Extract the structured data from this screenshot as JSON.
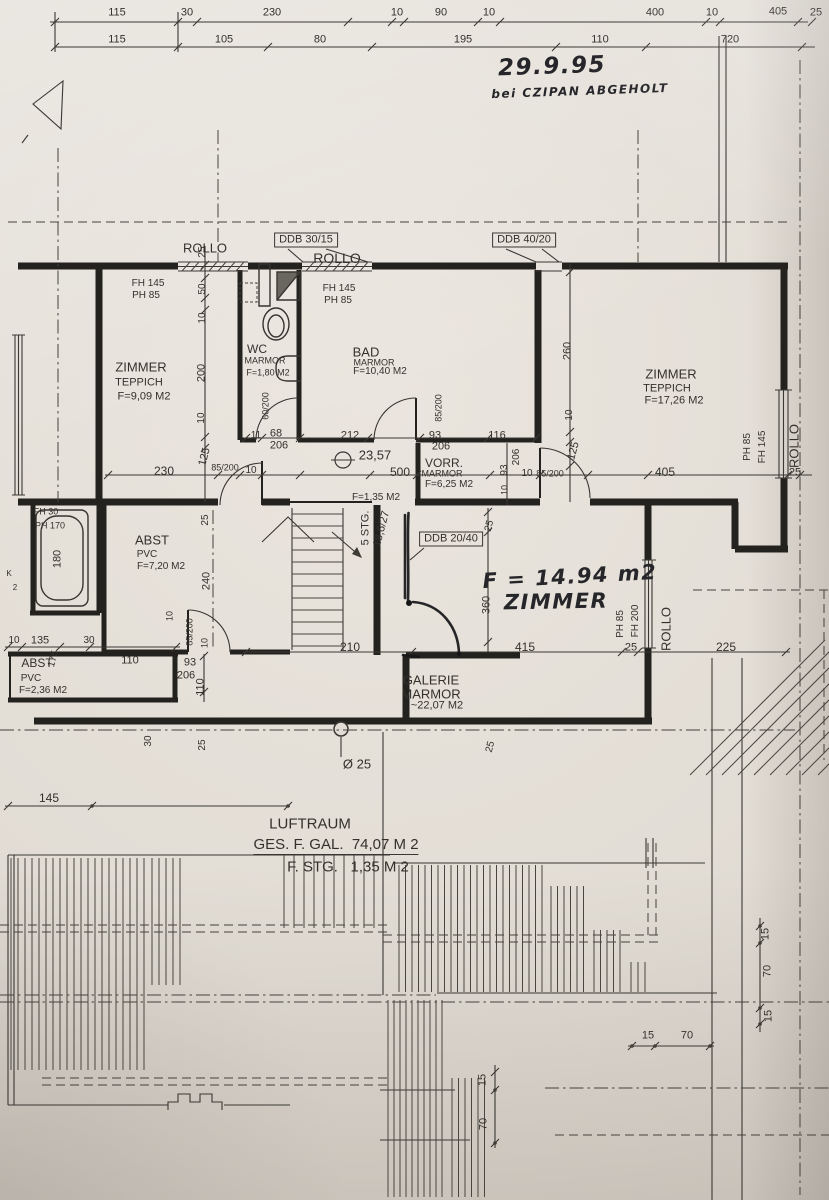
{
  "document": {
    "kind_note": "floor plan drawing"
  },
  "colors": {
    "paper": "#e1dcd4",
    "ink": "#3a3733",
    "wall": "#24221f",
    "pen": "#161618"
  },
  "labels": [
    {
      "t": "115",
      "x": 117,
      "y": 13,
      "s": 11,
      "n": "dim"
    },
    {
      "t": "30",
      "x": 187,
      "y": 13,
      "s": 11,
      "n": "dim"
    },
    {
      "t": "230",
      "x": 272,
      "y": 13,
      "s": 11,
      "n": "dim"
    },
    {
      "t": "10",
      "x": 397,
      "y": 13,
      "s": 11,
      "n": "dim"
    },
    {
      "t": "90",
      "x": 441,
      "y": 13,
      "s": 11,
      "n": "dim"
    },
    {
      "t": "10",
      "x": 489,
      "y": 13,
      "s": 11,
      "n": "dim"
    },
    {
      "t": "400",
      "x": 655,
      "y": 13,
      "s": 11,
      "n": "dim"
    },
    {
      "t": "10",
      "x": 712,
      "y": 13,
      "s": 11,
      "n": "dim"
    },
    {
      "t": "405",
      "x": 778,
      "y": 12,
      "s": 11,
      "n": "dim"
    },
    {
      "t": "25",
      "x": 816,
      "y": 13,
      "s": 11,
      "n": "dim"
    },
    {
      "t": "115",
      "x": 117,
      "y": 40,
      "s": 11,
      "n": "dim"
    },
    {
      "t": "105",
      "x": 224,
      "y": 40,
      "s": 11,
      "n": "dim"
    },
    {
      "t": "80",
      "x": 320,
      "y": 40,
      "s": 11,
      "n": "dim"
    },
    {
      "t": "195",
      "x": 463,
      "y": 40,
      "s": 11,
      "n": "dim"
    },
    {
      "t": "110",
      "x": 600,
      "y": 40,
      "s": 11,
      "n": "dim"
    },
    {
      "t": "720",
      "x": 730,
      "y": 40,
      "s": 11,
      "n": "dim"
    },
    {
      "t": "29.9.95",
      "x": 552,
      "y": 67,
      "s": 23,
      "r": -2,
      "c": "hand",
      "n": "hand-date"
    },
    {
      "t": "bei CZIPAN ABGEHOLT",
      "x": 580,
      "y": 91,
      "s": 12,
      "r": -2,
      "c": "hand",
      "n": "hand-note"
    },
    {
      "t": "ROLLO",
      "x": 205,
      "y": 248,
      "s": 13,
      "n": "rollo-label"
    },
    {
      "t": "ROLLO",
      "x": 337,
      "y": 258,
      "s": 14,
      "n": "rollo-label"
    },
    {
      "t": "DDB 30/15",
      "x": 306,
      "y": 240,
      "s": 11,
      "c": "boxed",
      "n": "ddb-label"
    },
    {
      "t": "DDB 40/20",
      "x": 524,
      "y": 240,
      "s": 11,
      "c": "boxed",
      "n": "ddb-label"
    },
    {
      "t": "FH 145",
      "x": 148,
      "y": 284,
      "s": 10,
      "n": "window-spec"
    },
    {
      "t": "PH 85",
      "x": 146,
      "y": 296,
      "s": 10,
      "n": "window-spec"
    },
    {
      "t": "FH 145",
      "x": 339,
      "y": 289,
      "s": 10,
      "n": "window-spec"
    },
    {
      "t": "PH 85",
      "x": 338,
      "y": 301,
      "s": 10,
      "n": "window-spec"
    },
    {
      "t": "25",
      "x": 203,
      "y": 252,
      "s": 10,
      "r": -90,
      "n": "dim"
    },
    {
      "t": "50",
      "x": 203,
      "y": 289,
      "s": 10,
      "r": -90,
      "n": "dim"
    },
    {
      "t": "10",
      "x": 203,
      "y": 318,
      "s": 10,
      "r": -90,
      "n": "dim"
    },
    {
      "t": "200",
      "x": 202,
      "y": 373,
      "s": 11,
      "r": -90,
      "n": "dim"
    },
    {
      "t": "10",
      "x": 202,
      "y": 418,
      "s": 10,
      "r": -90,
      "n": "dim"
    },
    {
      "t": "125",
      "x": 205,
      "y": 457,
      "s": 11,
      "r": -75,
      "n": "dim"
    },
    {
      "t": "ZIMMER",
      "x": 141,
      "y": 367,
      "s": 13,
      "n": "room-name"
    },
    {
      "t": "TEPPICH",
      "x": 139,
      "y": 383,
      "s": 11,
      "n": "room-floor"
    },
    {
      "t": "F=9,09 M2",
      "x": 144,
      "y": 397,
      "s": 11,
      "n": "room-area"
    },
    {
      "t": "WC",
      "x": 257,
      "y": 349,
      "s": 12,
      "n": "room-name"
    },
    {
      "t": "MARMOR",
      "x": 265,
      "y": 361,
      "s": 9,
      "n": "room-floor"
    },
    {
      "t": "F=1,80 M2",
      "x": 268,
      "y": 373,
      "s": 9,
      "n": "room-area"
    },
    {
      "t": "60/200",
      "x": 266,
      "y": 406,
      "s": 9,
      "r": -90,
      "n": "door-spec"
    },
    {
      "t": "BAD",
      "x": 366,
      "y": 352,
      "s": 13,
      "n": "room-name"
    },
    {
      "t": "MARMOR",
      "x": 374,
      "y": 363,
      "s": 9,
      "n": "room-floor"
    },
    {
      "t": "F=10,40 M2",
      "x": 380,
      "y": 372,
      "s": 10,
      "n": "room-area"
    },
    {
      "t": "85/200",
      "x": 439,
      "y": 408,
      "s": 9,
      "r": -90,
      "n": "door-spec"
    },
    {
      "t": "260",
      "x": 568,
      "y": 351,
      "s": 11,
      "r": -90,
      "n": "dim"
    },
    {
      "t": "10",
      "x": 570,
      "y": 415,
      "s": 10,
      "r": -90,
      "n": "dim"
    },
    {
      "t": "125",
      "x": 574,
      "y": 451,
      "s": 11,
      "r": -75,
      "n": "dim"
    },
    {
      "t": "ZIMMER",
      "x": 671,
      "y": 374,
      "s": 13,
      "n": "room-name"
    },
    {
      "t": "TEPPICH",
      "x": 667,
      "y": 389,
      "s": 11,
      "n": "room-floor"
    },
    {
      "t": "F=17,26 M2",
      "x": 674,
      "y": 401,
      "s": 11,
      "n": "room-area"
    },
    {
      "t": "PH 85",
      "x": 748,
      "y": 447,
      "s": 10,
      "r": -90,
      "n": "window-spec"
    },
    {
      "t": "FH 145",
      "x": 763,
      "y": 447,
      "s": 10,
      "r": -90,
      "n": "window-spec"
    },
    {
      "t": "ROLLO",
      "x": 794,
      "y": 446,
      "s": 13,
      "r": -90,
      "n": "rollo-label"
    },
    {
      "t": "405",
      "x": 665,
      "y": 472,
      "s": 12,
      "n": "dim"
    },
    {
      "t": "25",
      "x": 795,
      "y": 473,
      "s": 11,
      "n": "dim"
    },
    {
      "t": "230",
      "x": 164,
      "y": 471,
      "s": 12,
      "n": "dim"
    },
    {
      "t": "85/200",
      "x": 225,
      "y": 468,
      "s": 9,
      "n": "door-spec"
    },
    {
      "t": "10",
      "x": 251,
      "y": 471,
      "s": 10,
      "n": "dim"
    },
    {
      "t": "11",
      "x": 256,
      "y": 436,
      "s": 10,
      "n": "dim"
    },
    {
      "t": "68",
      "x": 276,
      "y": 434,
      "s": 11,
      "n": "dim"
    },
    {
      "t": "206",
      "x": 279,
      "y": 446,
      "s": 11,
      "n": "dim"
    },
    {
      "t": "212",
      "x": 350,
      "y": 436,
      "s": 11,
      "n": "dim"
    },
    {
      "t": "93",
      "x": 435,
      "y": 436,
      "s": 11,
      "n": "dim"
    },
    {
      "t": "206",
      "x": 441,
      "y": 447,
      "s": 11,
      "n": "dim"
    },
    {
      "t": "116",
      "x": 497,
      "y": 436,
      "s": 11,
      "n": "dim"
    },
    {
      "t": "23,57",
      "x": 375,
      "y": 455,
      "s": 13,
      "n": "level-label"
    },
    {
      "t": "500",
      "x": 400,
      "y": 472,
      "s": 12,
      "n": "dim"
    },
    {
      "t": "VORR.",
      "x": 444,
      "y": 463,
      "s": 12,
      "n": "room-name"
    },
    {
      "t": "MARMOR",
      "x": 442,
      "y": 474,
      "s": 9,
      "n": "room-floor"
    },
    {
      "t": "F=6,25 M2",
      "x": 449,
      "y": 485,
      "s": 10,
      "n": "room-area"
    },
    {
      "t": "93",
      "x": 505,
      "y": 470,
      "s": 10,
      "r": -90,
      "n": "dim"
    },
    {
      "t": "206",
      "x": 517,
      "y": 457,
      "s": 10,
      "r": -90,
      "n": "dim"
    },
    {
      "t": "10",
      "x": 527,
      "y": 474,
      "s": 10,
      "n": "dim"
    },
    {
      "t": "10",
      "x": 505,
      "y": 490,
      "s": 9,
      "r": -90,
      "n": "dim"
    },
    {
      "t": "85/200",
      "x": 550,
      "y": 474,
      "s": 9,
      "n": "door-spec"
    },
    {
      "t": "FH 30",
      "x": 46,
      "y": 512,
      "s": 9,
      "n": "window-spec"
    },
    {
      "t": "PH 170",
      "x": 50,
      "y": 526,
      "s": 9,
      "n": "window-spec"
    },
    {
      "t": "180",
      "x": 58,
      "y": 559,
      "s": 11,
      "r": -90,
      "n": "dim"
    },
    {
      "t": "K",
      "x": 9,
      "y": 574,
      "s": 8,
      "n": "dim"
    },
    {
      "t": "2",
      "x": 15,
      "y": 588,
      "s": 8,
      "n": "dim"
    },
    {
      "t": "ABST",
      "x": 152,
      "y": 540,
      "s": 13,
      "n": "room-name"
    },
    {
      "t": "PVC",
      "x": 147,
      "y": 555,
      "s": 10,
      "n": "room-floor"
    },
    {
      "t": "F=7,20 M2",
      "x": 161,
      "y": 567,
      "s": 10,
      "n": "room-area"
    },
    {
      "t": "25",
      "x": 206,
      "y": 520,
      "s": 10,
      "r": -90,
      "n": "dim"
    },
    {
      "t": "240",
      "x": 207,
      "y": 581,
      "s": 11,
      "r": -90,
      "n": "dim"
    },
    {
      "t": "85/200",
      "x": 190,
      "y": 632,
      "s": 9,
      "r": -90,
      "n": "door-spec"
    },
    {
      "t": "10",
      "x": 205,
      "y": 643,
      "s": 9,
      "r": -90,
      "n": "dim"
    },
    {
      "t": "5 STG.",
      "x": 366,
      "y": 528,
      "s": 11,
      "r": -90,
      "n": "stair-label"
    },
    {
      "t": "18,6/27",
      "x": 382,
      "y": 529,
      "s": 11,
      "r": -75,
      "n": "stair-label"
    },
    {
      "t": "F=1,35 M2",
      "x": 376,
      "y": 498,
      "s": 10,
      "n": "room-area"
    },
    {
      "t": "DDB 20/40",
      "x": 451,
      "y": 539,
      "s": 11,
      "c": "boxed",
      "n": "ddb-label"
    },
    {
      "t": "25",
      "x": 490,
      "y": 526,
      "s": 10,
      "r": -75,
      "n": "dim"
    },
    {
      "t": "360",
      "x": 487,
      "y": 605,
      "s": 11,
      "r": -90,
      "n": "dim"
    },
    {
      "t": "F = 14.94 m2",
      "x": 570,
      "y": 577,
      "s": 21,
      "r": -3,
      "c": "hand",
      "n": "hand-area"
    },
    {
      "t": "ZIMMER",
      "x": 556,
      "y": 602,
      "s": 21,
      "r": -1,
      "c": "hand",
      "n": "hand-room"
    },
    {
      "t": "PH 85",
      "x": 621,
      "y": 624,
      "s": 10,
      "r": -90,
      "n": "window-spec"
    },
    {
      "t": "FH 200",
      "x": 636,
      "y": 621,
      "s": 10,
      "r": -90,
      "n": "window-spec"
    },
    {
      "t": "ROLLO",
      "x": 666,
      "y": 629,
      "s": 13,
      "r": -90,
      "n": "rollo-label"
    },
    {
      "t": "25",
      "x": 631,
      "y": 648,
      "s": 11,
      "n": "dim"
    },
    {
      "t": "225",
      "x": 726,
      "y": 647,
      "s": 12,
      "n": "dim"
    },
    {
      "t": "415",
      "x": 525,
      "y": 647,
      "s": 12,
      "n": "dim"
    },
    {
      "t": "210",
      "x": 350,
      "y": 647,
      "s": 12,
      "n": "dim"
    },
    {
      "t": "GALERIE",
      "x": 431,
      "y": 680,
      "s": 13,
      "n": "room-name"
    },
    {
      "t": "MARMOR",
      "x": 431,
      "y": 694,
      "s": 13,
      "n": "room-floor"
    },
    {
      "t": "~22,07 M2",
      "x": 437,
      "y": 706,
      "s": 11,
      "n": "room-area"
    },
    {
      "t": "110",
      "x": 130,
      "y": 661,
      "s": 11,
      "n": "dim"
    },
    {
      "t": "93",
      "x": 190,
      "y": 663,
      "s": 11,
      "n": "dim"
    },
    {
      "t": "206",
      "x": 186,
      "y": 676,
      "s": 11,
      "n": "dim"
    },
    {
      "t": "110",
      "x": 201,
      "y": 687,
      "s": 11,
      "r": -90,
      "n": "dim"
    },
    {
      "t": "10",
      "x": 14,
      "y": 641,
      "s": 10,
      "n": "dim"
    },
    {
      "t": "135",
      "x": 40,
      "y": 641,
      "s": 11,
      "n": "dim"
    },
    {
      "t": "30",
      "x": 89,
      "y": 641,
      "s": 10,
      "n": "dim"
    },
    {
      "t": "175",
      "x": 54,
      "y": 659,
      "s": 10,
      "r": -75,
      "n": "dim"
    },
    {
      "t": "ABST",
      "x": 37,
      "y": 663,
      "s": 12,
      "n": "room-name"
    },
    {
      "t": "PVC",
      "x": 31,
      "y": 679,
      "s": 10,
      "n": "room-floor"
    },
    {
      "t": "F=2,36 M2",
      "x": 43,
      "y": 691,
      "s": 10,
      "n": "room-area"
    },
    {
      "t": "10",
      "x": 170,
      "y": 616,
      "s": 9,
      "r": -90,
      "n": "dim"
    },
    {
      "t": "30",
      "x": 149,
      "y": 741,
      "s": 10,
      "r": -90,
      "n": "dim"
    },
    {
      "t": "25",
      "x": 203,
      "y": 745,
      "s": 10,
      "r": -90,
      "n": "dim"
    },
    {
      "t": "25",
      "x": 491,
      "y": 747,
      "s": 10,
      "r": -75,
      "n": "dim"
    },
    {
      "t": "Ø 25",
      "x": 357,
      "y": 764,
      "s": 13,
      "n": "column-label"
    },
    {
      "t": "145",
      "x": 49,
      "y": 798,
      "s": 12,
      "n": "dim"
    },
    {
      "t": "LUFTRAUM",
      "x": 310,
      "y": 824,
      "s": 15,
      "n": "luftraum-title"
    },
    {
      "t": "GES. F. GAL.  74,07 M 2",
      "x": 336,
      "y": 846,
      "s": 15,
      "c": "underline",
      "n": "luftraum-area"
    },
    {
      "t": "F. STG.   1,35 M 2",
      "x": 348,
      "y": 867,
      "s": 15,
      "n": "luftraum-stair-area"
    },
    {
      "t": "15",
      "x": 648,
      "y": 1036,
      "s": 11,
      "n": "dim"
    },
    {
      "t": "70",
      "x": 687,
      "y": 1036,
      "s": 11,
      "n": "dim"
    },
    {
      "t": "15",
      "x": 766,
      "y": 934,
      "s": 11,
      "r": -90,
      "n": "dim"
    },
    {
      "t": "70",
      "x": 768,
      "y": 971,
      "s": 11,
      "r": -90,
      "n": "dim"
    },
    {
      "t": "15",
      "x": 769,
      "y": 1016,
      "s": 11,
      "r": -90,
      "n": "dim"
    },
    {
      "t": "15",
      "x": 483,
      "y": 1080,
      "s": 11,
      "r": -90,
      "n": "dim"
    },
    {
      "t": "70",
      "x": 484,
      "y": 1124,
      "s": 11,
      "r": -90,
      "n": "dim"
    }
  ]
}
